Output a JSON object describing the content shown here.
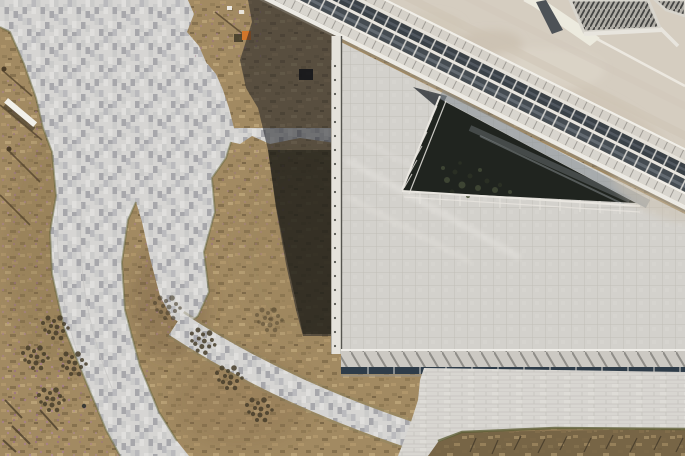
{
  "scene": {
    "type": "aerial-architectural-photograph",
    "description": "Top-down drone photograph of a modern building: a diagonal rooftop glazing band with railed walkways, a dark triangular sunken skylight courtyard with plantings, a square-tiled roof plaza, a pixel-patterned paver plaza, curved paver paths sweeping through dry winter lawns, and a hard building shadow cast to the lower left.",
    "lighting": "low sun from the left casting a long dark building shadow across plaza and lawn"
  },
  "palette": {
    "grass_base": "#a28a62",
    "grass_dark_patch": "#7c6848",
    "bottom_grass": "#776546",
    "flower_fleck": "#a87f92",
    "shrub": "#473e2b",
    "weed_edge": "#65663c",
    "paver_light": "#d6d5d3",
    "paver_dark": "#a7a7ab",
    "tile_roof": "#d3d1cc",
    "tile_line": "#c1beb7",
    "brick_ground": "#d8d6d1",
    "concrete": "#d5cdc0",
    "concrete_stain": "#c3b6a4",
    "white_rail": "#eceae4",
    "walkway": "#d8d5ce",
    "glass_dark": "#454c52",
    "glass_reflection": "#7d858d",
    "skylight_void": "#20241f",
    "plant_green": "#3d4433",
    "parapet": "#e5e2db",
    "canopy": "#ccc9c3",
    "glazing_bar": "#2e3c49",
    "louvre_base": "#b0ada6",
    "louvre_line": "#454543",
    "beam_dark": "#4d5257",
    "building_shadow": "#1c1d22",
    "equipment_orange": "#d2762a",
    "bench_white": "#f2f0ea"
  },
  "regions": {
    "pixel_plaza": "pixel-patterned paver plaza",
    "lawn": "dry winter lawn with pink ground-cover flecks",
    "lawn_notch": "lawn notch at top of plaza",
    "grass_tongue": "lawn tongue between plaza fingers",
    "wide_curved_walk": "wide curved paver walkway",
    "curved_path": "narrow curved paver path",
    "building_shadow": "building shadow wedge",
    "roof_tile_plaza": "square-tiled roof terrace",
    "skylight": "triangular skylight void with planting",
    "glass_band": "diagonal rooftop glazing band with walkways and railings",
    "concrete_roof": "bare concrete roof slab with stains",
    "rooftop_vents": "rooftop louvre vent units and grating",
    "canopy": "roof edge canopy with diagonal struts over glazing",
    "ground_pavement": "ground-level brick paving",
    "bottom_lawn": "lawn strip at bottom edge",
    "shrubs": "clipped shrub clusters",
    "bench": "white bench in lawn",
    "equipment": "orange maintenance equipment on lawn"
  }
}
